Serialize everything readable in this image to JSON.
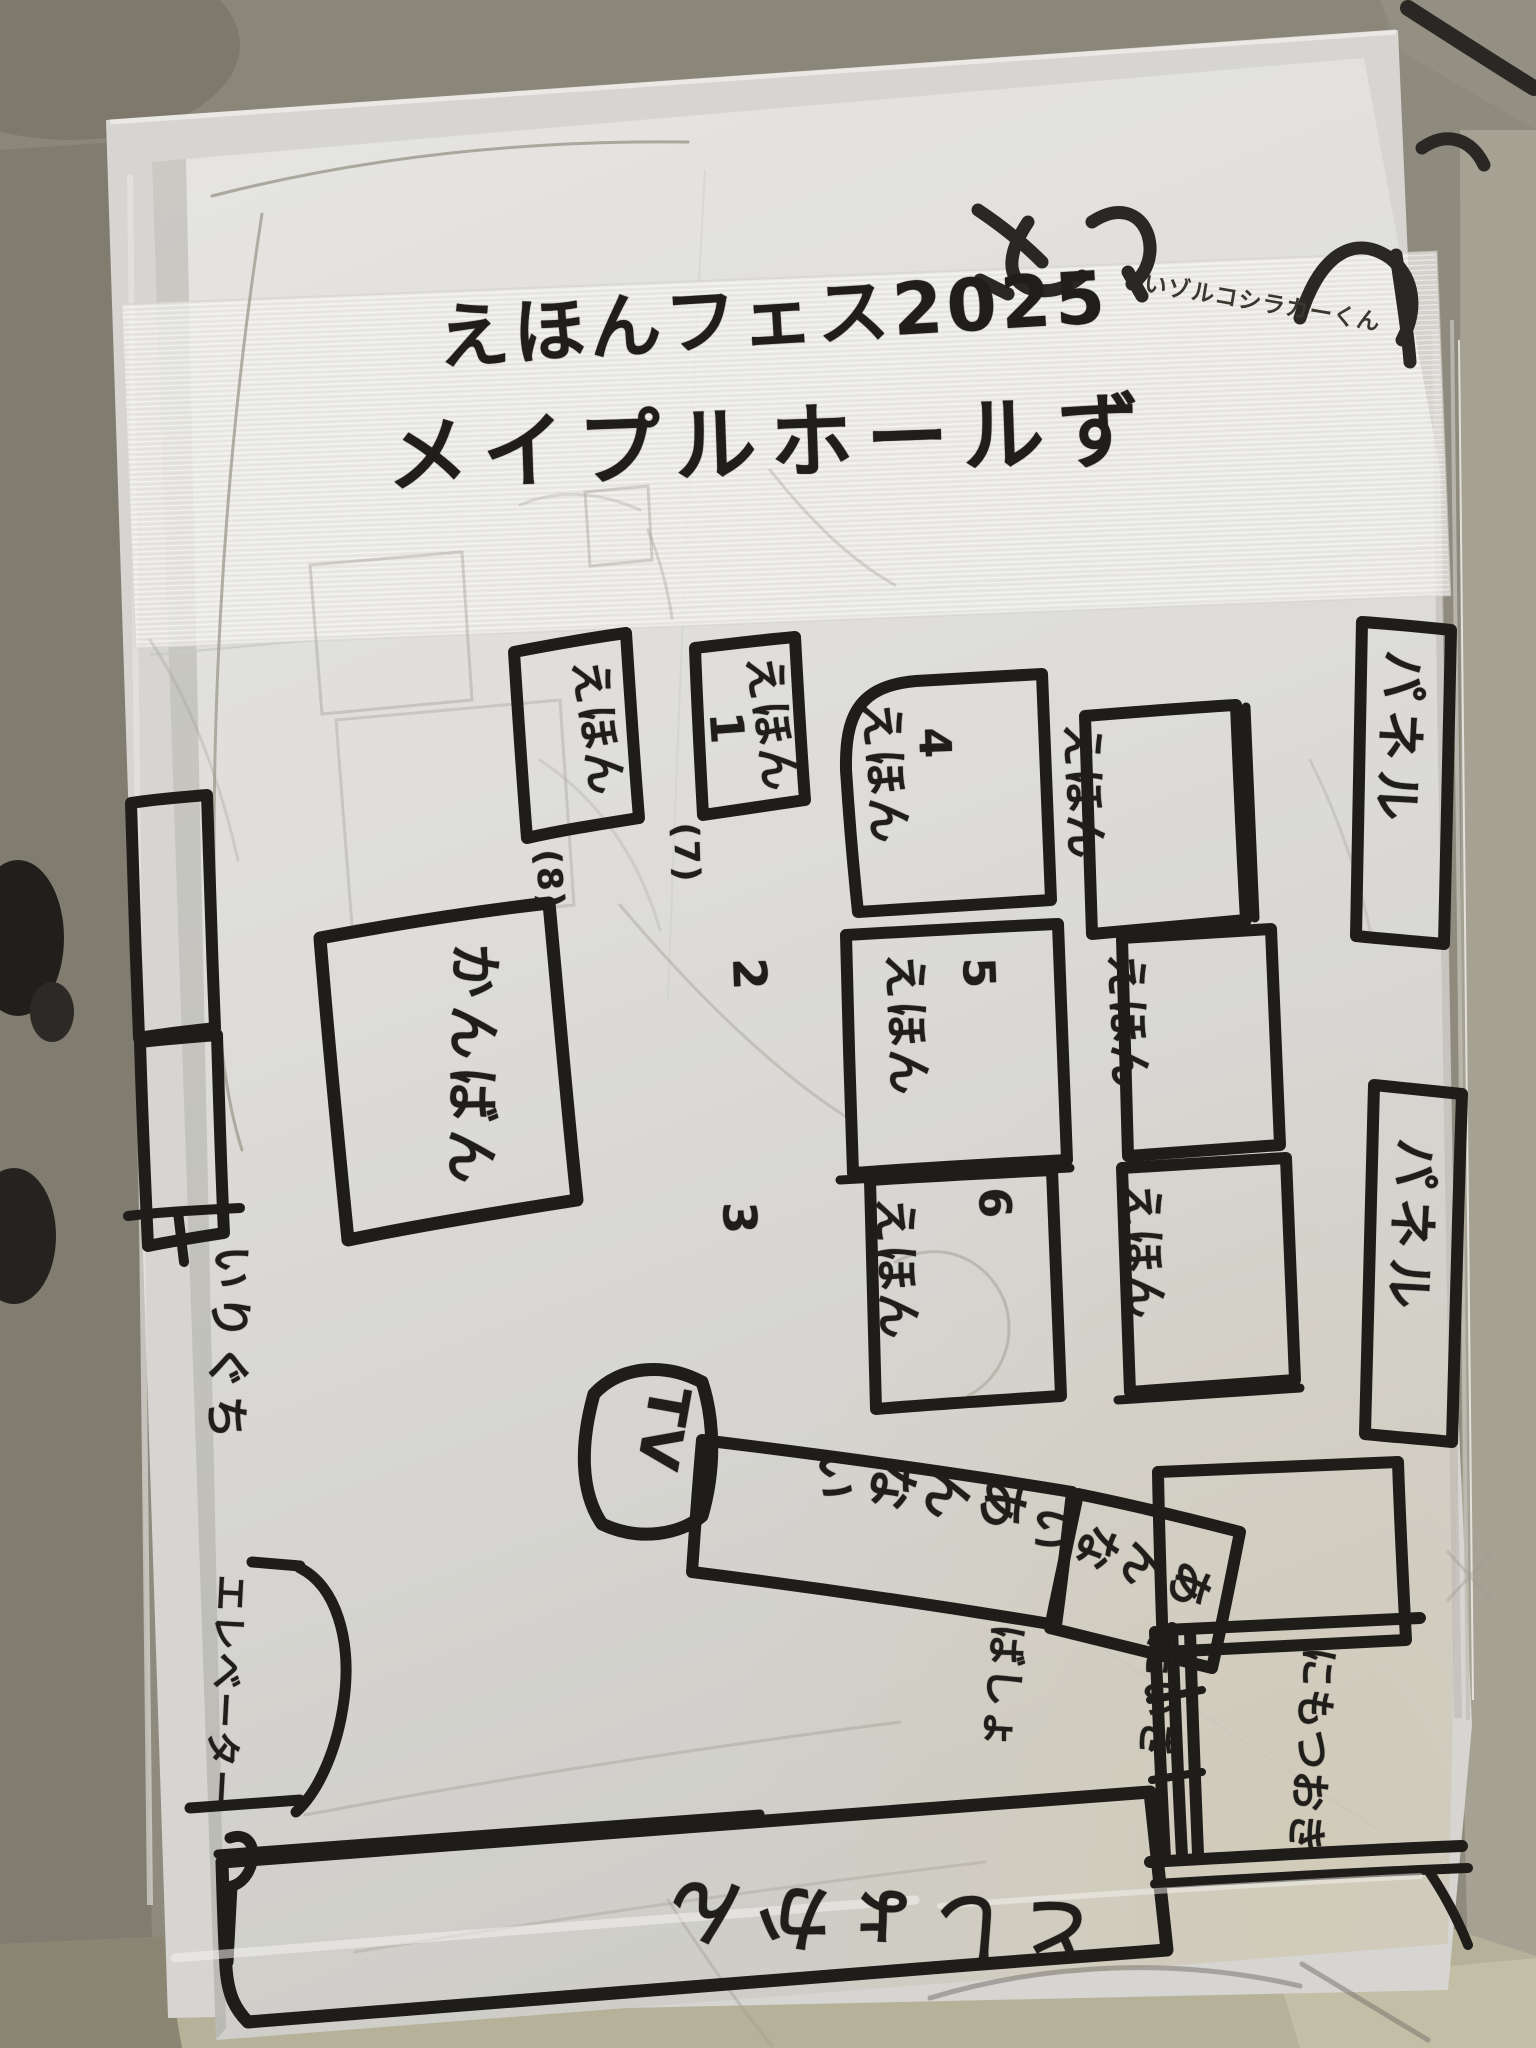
{
  "title": {
    "line1": "えほんフェス2025",
    "line2": "メイプルホールず"
  },
  "corner_note": "いゾルコシラカーくん",
  "panels": {
    "panel_1": "パネル",
    "panel_2": "パネル"
  },
  "booths": {
    "e1": {
      "label": "えほん",
      "number": "1"
    },
    "e2": {
      "label": "えほん",
      "number": "2"
    },
    "e3": {
      "label": "えほん",
      "number": "3"
    },
    "e4": {
      "label": "えほん",
      "number": "4"
    },
    "e5": {
      "label": "えほん",
      "number": "5"
    },
    "e6": {
      "label": "えほん",
      "number": "6"
    },
    "e7": {
      "label": "えほん",
      "number": "(7)"
    },
    "e8": {
      "label": "えほん",
      "number": "(8)"
    }
  },
  "signboard": "かんばん",
  "tv": "TV",
  "info": {
    "sign_1": "あんない",
    "sign_2": "あんない"
  },
  "entrance": "いりぐち",
  "elevator": "エレベーター",
  "library": "としょかん",
  "luggage": {
    "line1": "にもつおき",
    "line2": "たいき",
    "line3": "ばしょ"
  },
  "colors": {
    "marker_ink": "#1f1d1a",
    "paper": "#e2e1de",
    "tape": "#edece8",
    "sleeve": "#d6d5d2",
    "background": "#8e8a7e",
    "pencil": "#a09c92"
  }
}
